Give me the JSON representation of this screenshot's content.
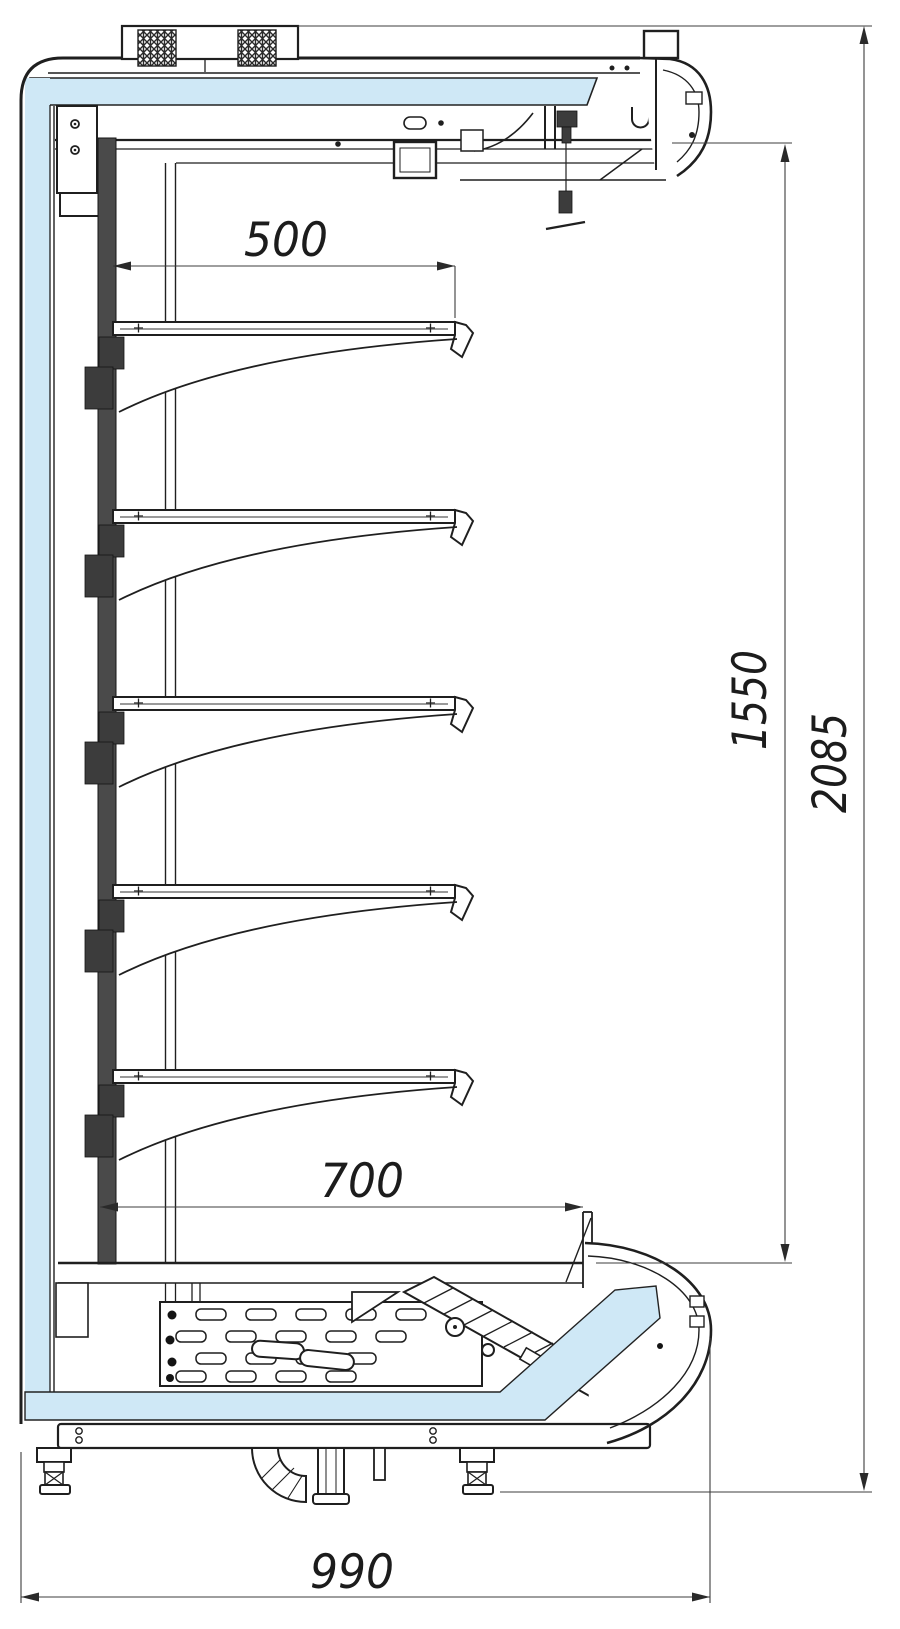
{
  "dims": {
    "shelf_depth": "500",
    "well_depth": "700",
    "opening_height": "1550",
    "overall_height": "2085",
    "overall_depth": "990"
  },
  "colors": {
    "insulation_fill": "#cfe8f6",
    "line": "#1f1f1f",
    "dimension_line": "#3c3c3c",
    "background": "#ffffff"
  },
  "shelf_count": 5
}
